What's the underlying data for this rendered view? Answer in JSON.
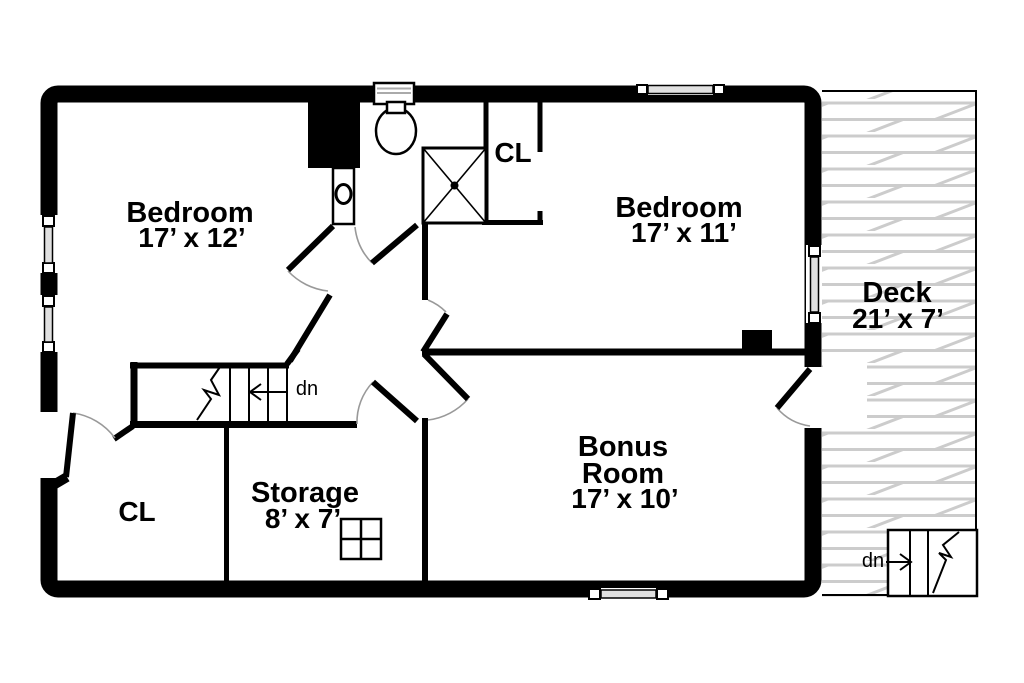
{
  "floorplan": {
    "type": "residential-upper-floor-plan",
    "rooms": {
      "bedroom1": {
        "name": "Bedroom",
        "dims": "17’ x 12’"
      },
      "bedroom2": {
        "name": "Bedroom",
        "dims": "17’ x 11’"
      },
      "bonus": {
        "name_line1": "Bonus",
        "name_line2": "Room",
        "dims": "17’ x 10’"
      },
      "storage": {
        "name": "Storage",
        "dims": "8’ x 7’"
      },
      "closet_upper": {
        "name": "CL"
      },
      "closet_lower": {
        "name": "CL"
      },
      "deck": {
        "name": "Deck",
        "dims": "21’ x 7’"
      }
    },
    "stairs": {
      "main": {
        "label": "dn"
      },
      "deck": {
        "label": "dn"
      }
    },
    "fixtures": [
      "toilet",
      "shower-stall",
      "chimney",
      "closet-circle",
      "window-symbol"
    ],
    "colors": {
      "walls": "#000000",
      "background": "#ffffff",
      "deck_planks": "#cccccc",
      "door_swing_arcs": "#999999"
    }
  }
}
